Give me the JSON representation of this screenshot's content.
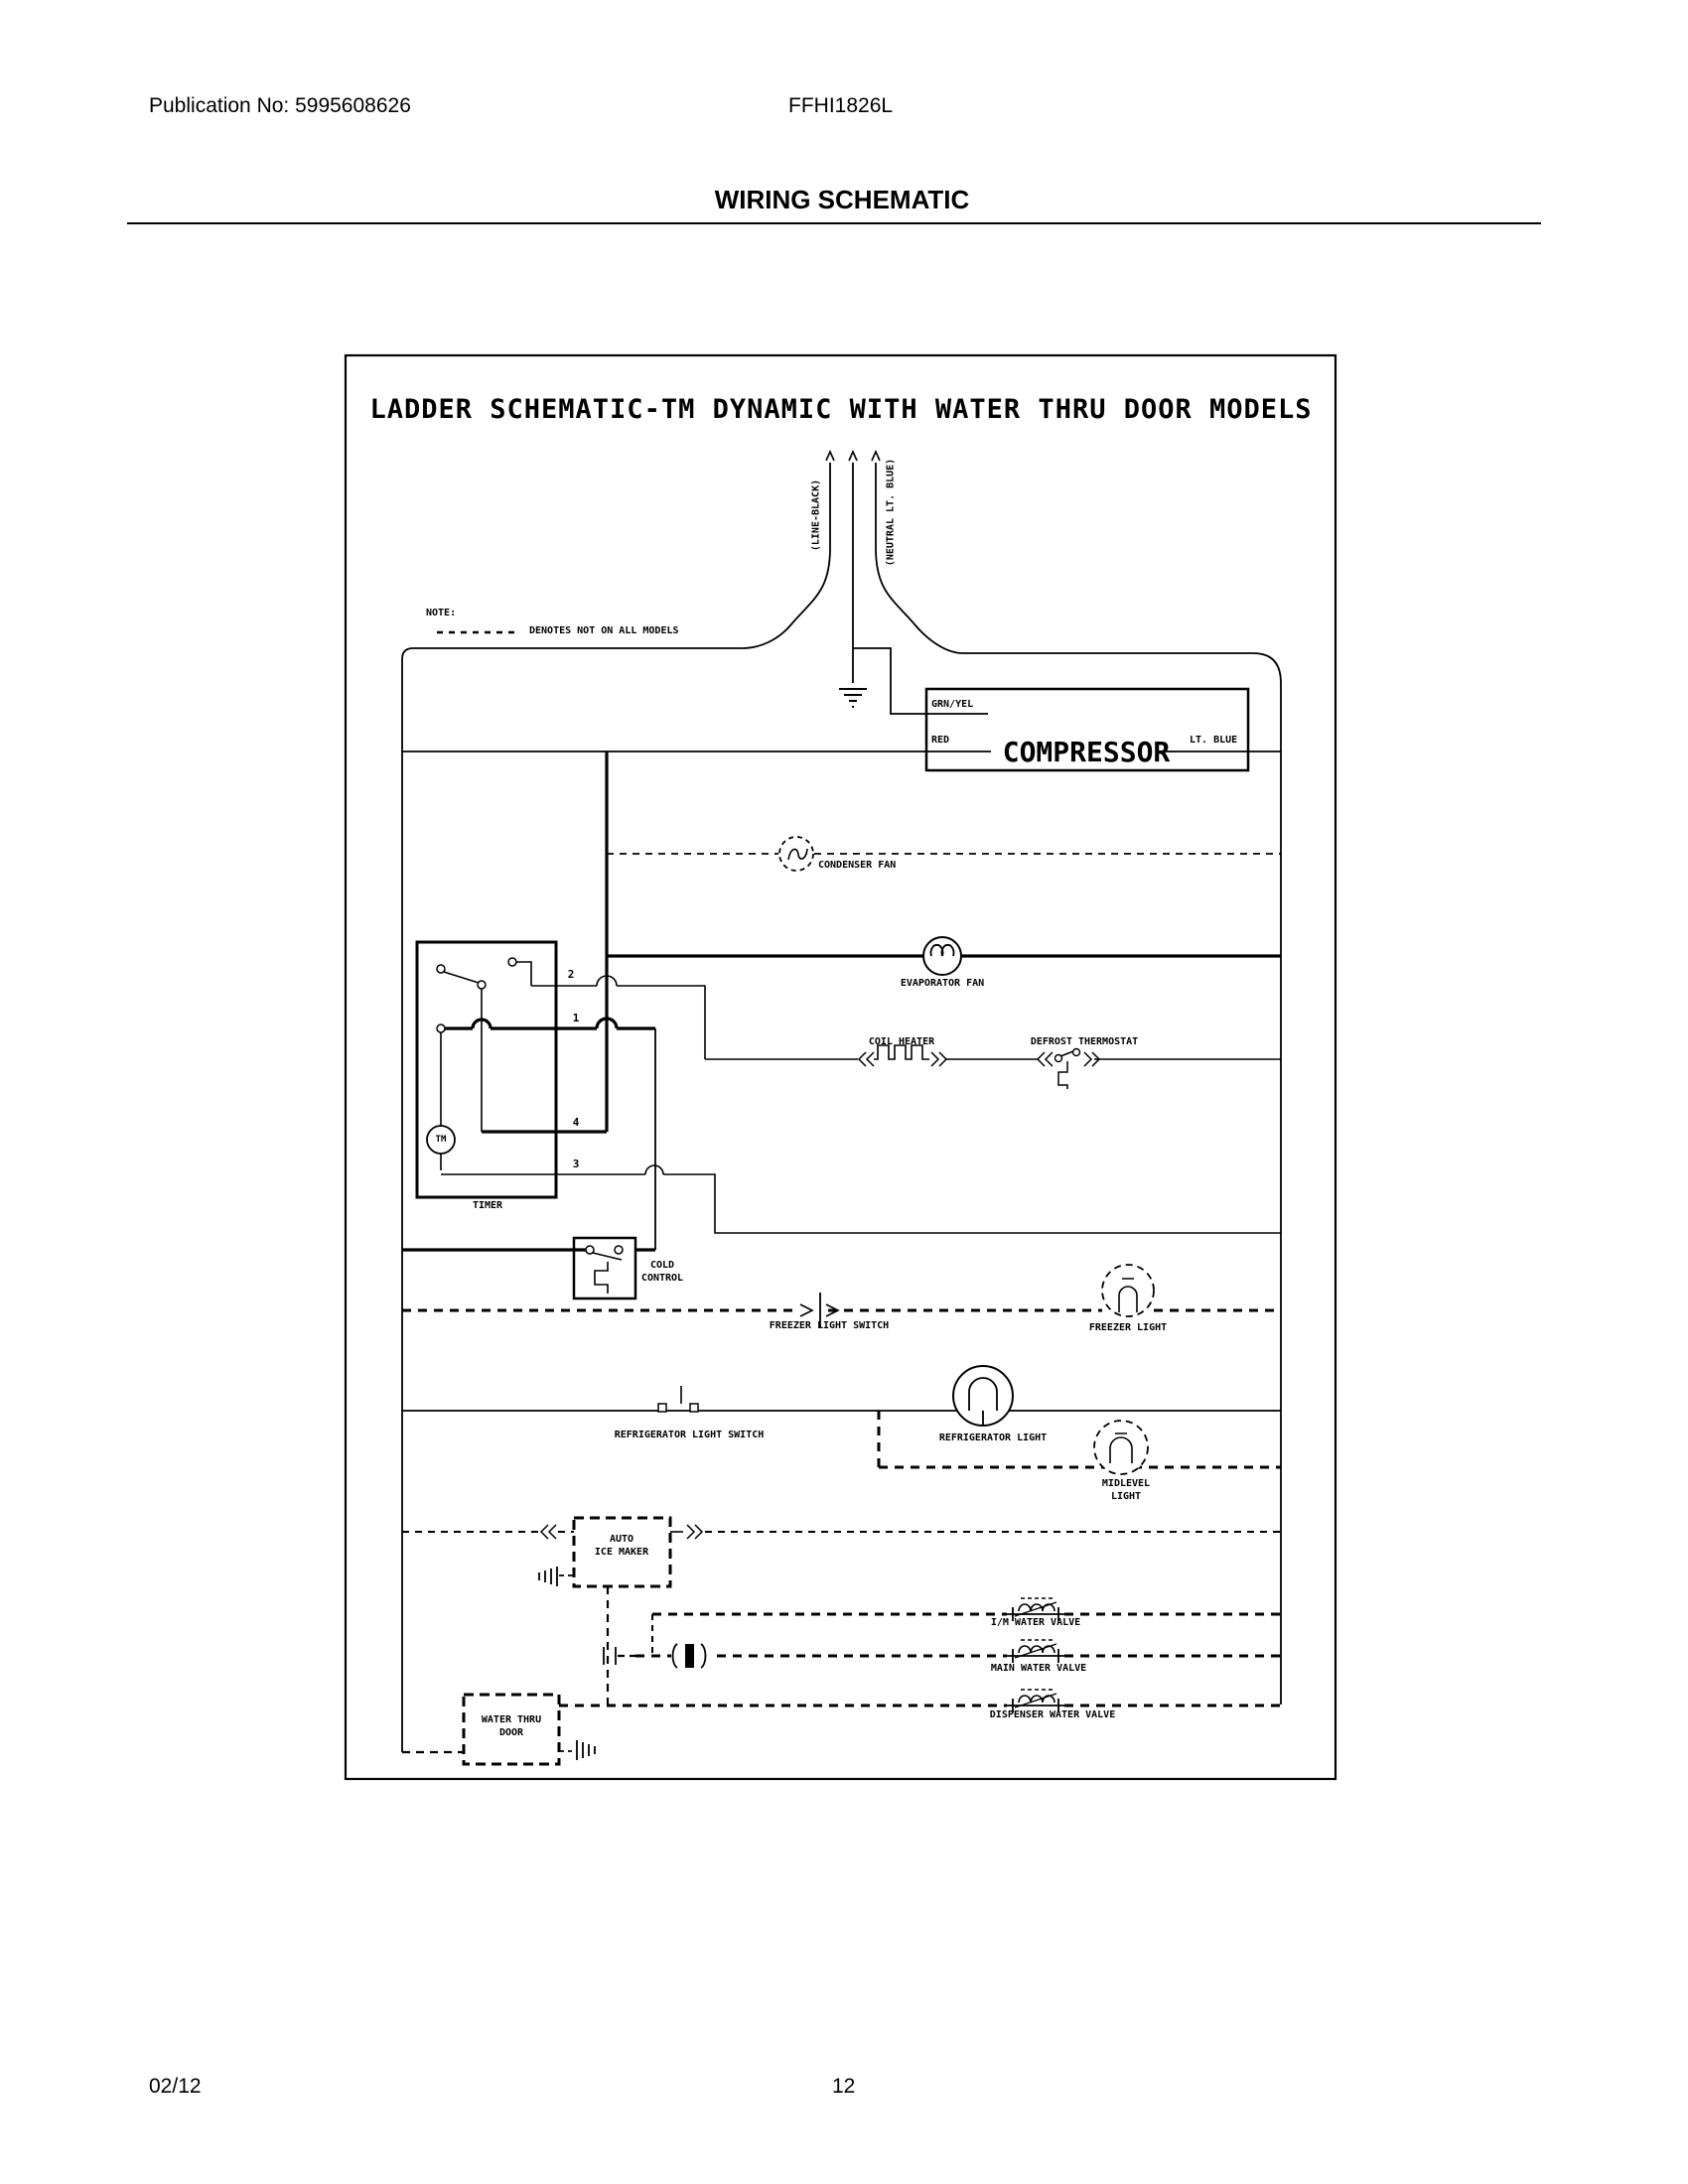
{
  "header": {
    "publication": "Publication No: 5995608626",
    "model": "FFHI1826L",
    "title": "WIRING SCHEMATIC"
  },
  "footer": {
    "date": "02/12",
    "page": "12"
  },
  "schematic": {
    "title": "LADDER SCHEMATIC-TM DYNAMIC WITH WATER THRU DOOR MODELS",
    "note_label": "NOTE:",
    "note_text": "DENOTES NOT ON ALL MODELS",
    "wire_labels": {
      "line": "(LINE-BLACK)",
      "neutral": "(NEUTRAL LT. BLUE)",
      "grn_yel": "GRN/YEL",
      "red": "RED",
      "lt_blue": "LT. BLUE"
    },
    "components": {
      "compressor": "COMPRESSOR",
      "condenser_fan": "CONDENSER FAN",
      "evaporator_fan": "EVAPORATOR FAN",
      "coil_heater": "COIL HEATER",
      "defrost_thermostat": "DEFROST THERMOSTAT",
      "timer": "TIMER",
      "timer_motor": "TM",
      "cold_control_line1": "COLD",
      "cold_control_line2": "CONTROL",
      "freezer_light_switch": "FREEZER LIGHT SWITCH",
      "freezer_light": "FREEZER LIGHT",
      "refrigerator_light_switch": "REFRIGERATOR LIGHT SWITCH",
      "refrigerator_light": "REFRIGERATOR LIGHT",
      "midlevel_light_line1": "MIDLEVEL",
      "midlevel_light_line2": "LIGHT",
      "ice_maker_line1": "AUTO",
      "ice_maker_line2": "ICE MAKER",
      "im_water_valve": "I/M WATER VALVE",
      "main_water_valve": "MAIN WATER VALVE",
      "dispenser_water_valve": "DISPENSER WATER VALVE",
      "water_thru_door_line1": "WATER THRU",
      "water_thru_door_line2": "DOOR"
    },
    "timer_terminals": {
      "t1": "1",
      "t2": "2",
      "t3": "3",
      "t4": "4"
    }
  }
}
